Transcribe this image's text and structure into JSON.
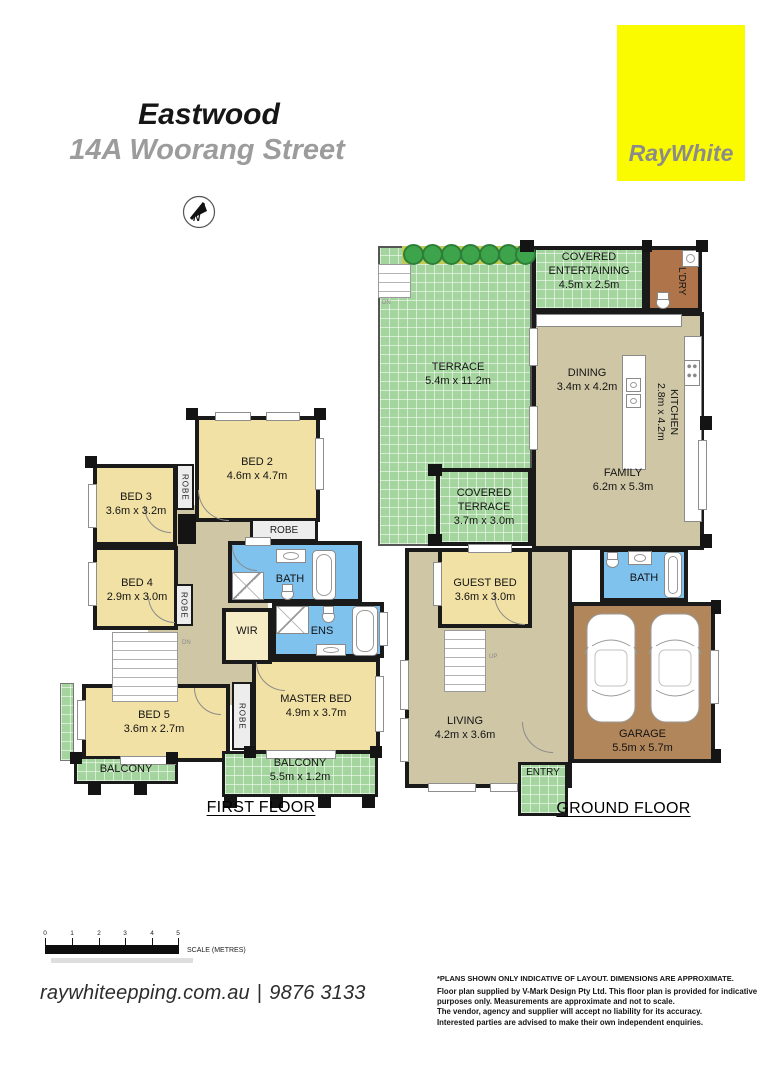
{
  "header": {
    "suburb": "Eastwood",
    "address": "14A Woorang Street",
    "compass_label": "N",
    "brand": "RayWhite"
  },
  "ground_floor": {
    "label": "GROUND FLOOR",
    "stair_label": "UP",
    "terrace_stair_label": "DN",
    "rooms": {
      "terrace": {
        "name": "TERRACE",
        "dims": "5.4m x 11.2m"
      },
      "covered_entertaining": {
        "name": "COVERED ENTERTAINING",
        "dims": "4.5m x 2.5m"
      },
      "laundry": {
        "name": "L'DRY"
      },
      "dining": {
        "name": "DINING",
        "dims": "3.4m x 4.2m"
      },
      "kitchen": {
        "name": "KITCHEN",
        "dims": "2.8m x 4.2m"
      },
      "family": {
        "name": "FAMILY",
        "dims": "6.2m x 5.3m"
      },
      "covered_terrace": {
        "name": "COVERED TERRACE",
        "dims": "3.7m x 3.0m"
      },
      "guest_bed": {
        "name": "GUEST BED",
        "dims": "3.6m x 3.0m"
      },
      "bath": {
        "name": "BATH"
      },
      "living": {
        "name": "LIVING",
        "dims": "4.2m x 3.6m"
      },
      "garage": {
        "name": "GARAGE",
        "dims": "5.5m x 5.7m"
      },
      "entry": {
        "name": "ENTRY"
      }
    }
  },
  "first_floor": {
    "label": "FIRST FLOOR",
    "stair_label": "DN",
    "rooms": {
      "bed2": {
        "name": "BED 2",
        "dims": "4.6m x 4.7m"
      },
      "bed3": {
        "name": "BED 3",
        "dims": "3.6m x 3.2m"
      },
      "bed4": {
        "name": "BED 4",
        "dims": "2.9m x 3.0m"
      },
      "bed5": {
        "name": "BED 5",
        "dims": "3.6m x 2.7m"
      },
      "master_bed": {
        "name": "MASTER BED",
        "dims": "4.9m x 3.7m"
      },
      "bath": {
        "name": "BATH"
      },
      "ens": {
        "name": "ENS"
      },
      "wir": {
        "name": "WIR"
      },
      "robe_bed2": {
        "name": "ROBE"
      },
      "robe_bed3": {
        "name": "ROBE"
      },
      "robe_bed4": {
        "name": "ROBE"
      },
      "robe_master": {
        "name": "ROBE"
      },
      "balcony_left": {
        "name": "BALCONY"
      },
      "balcony_right": {
        "name": "BALCONY",
        "dims": "5.5m x 1.2m"
      }
    }
  },
  "scale_bar": {
    "ticks": [
      "0",
      "1",
      "2",
      "3",
      "4",
      "5"
    ],
    "label": "SCALE (METRES)"
  },
  "footer": {
    "website": "raywhiteepping.com.au",
    "separator": "|",
    "phone": "9876 3133",
    "disclaimer_title": "*PLANS SHOWN ONLY INDICATIVE OF LAYOUT. DIMENSIONS ARE APPROXIMATE.",
    "disclaimer_lines": [
      "Floor plan supplied by V-Mark Design Pty Ltd. This floor plan is provided for indicative",
      "purposes only. Measurements are approximate and not to scale.",
      "The vendor, agency and supplier will accept no liability for its accuracy.",
      "Interested parties are advised to make their own independent enquiries."
    ]
  },
  "colors": {
    "brand_yellow": "#FBFB00",
    "bedroom_fill": "#F2E1A4",
    "living_fill": "#CFC6A6",
    "outdoor_fill": "#A5D59E",
    "bath_fill": "#7FC2EE",
    "garage_fill": "#B2865B",
    "laundry_fill": "#B0744A",
    "wall": "#1A1A1A"
  }
}
